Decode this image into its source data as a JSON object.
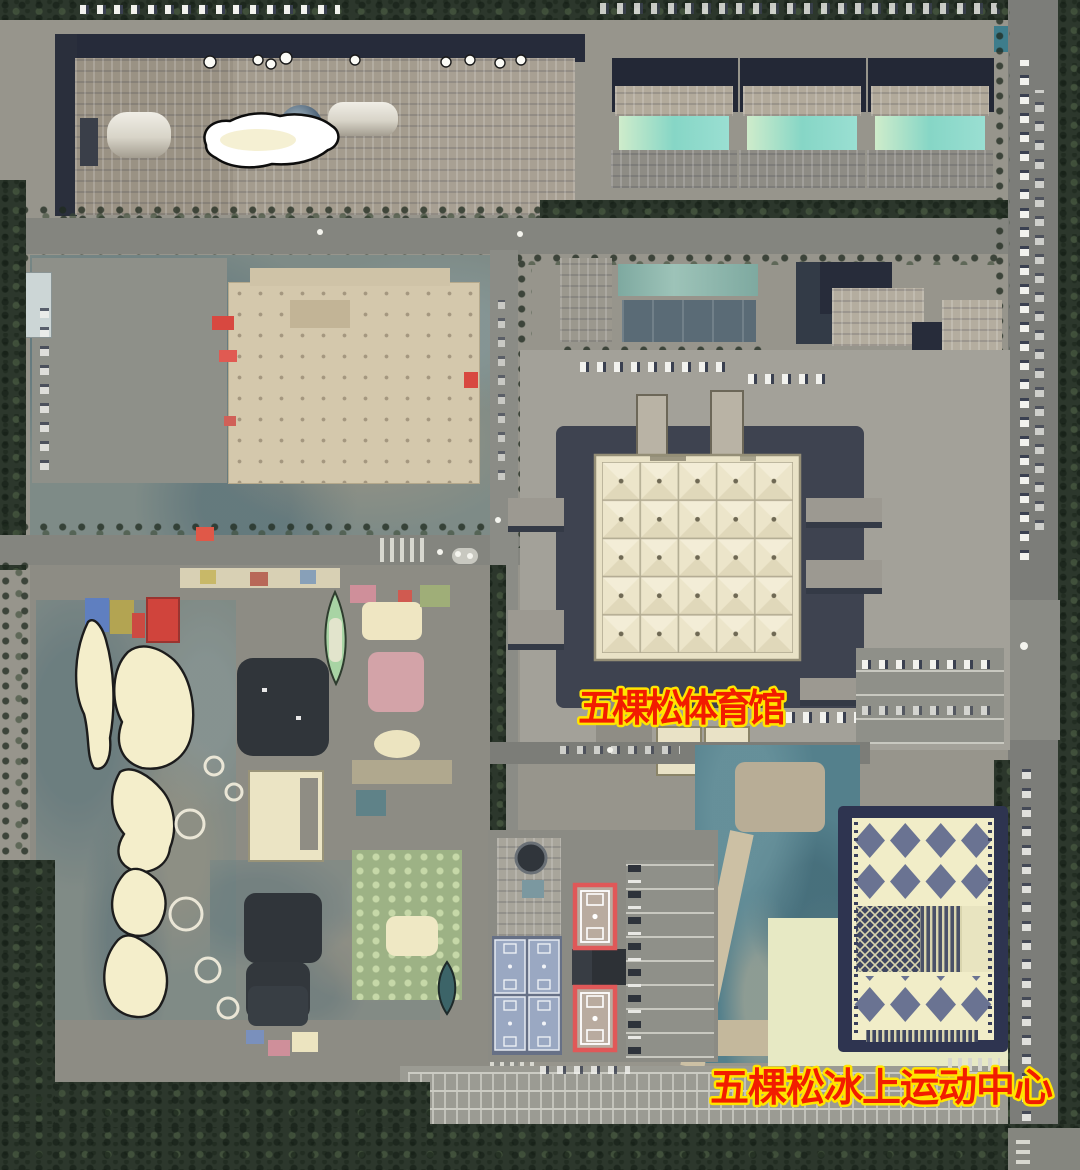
{
  "map": {
    "kind": "satellite-imagery",
    "labels": [
      {
        "id": "wukesong-arena",
        "text": "五棵松体育馆",
        "font_size": 38
      },
      {
        "id": "wukesong-ice-sports-center",
        "text": "五棵松冰上运动中心",
        "font_size": 39
      }
    ],
    "label_style": {
      "fill": "#f21c00",
      "outline": "#ffe400"
    }
  },
  "palette": {
    "pavement": "#97958c",
    "asphalt_dark": "#3e4350",
    "shadow_navy": "#262b3a",
    "arena_roof": "#ece5ca",
    "ice_center_roof": "#f1edc8",
    "ice_lattice": "#5b668c",
    "construction_tarp": "#54808c",
    "dirt_platform": "#d4c8ac",
    "tree_canopy": "#2c372c",
    "atrium_glass": "#8fd9c9",
    "court_red": "#e05858",
    "court_blue": "#9aa8c2",
    "tent_cream": "#f4eecb",
    "pool_dark": "#30353a"
  }
}
